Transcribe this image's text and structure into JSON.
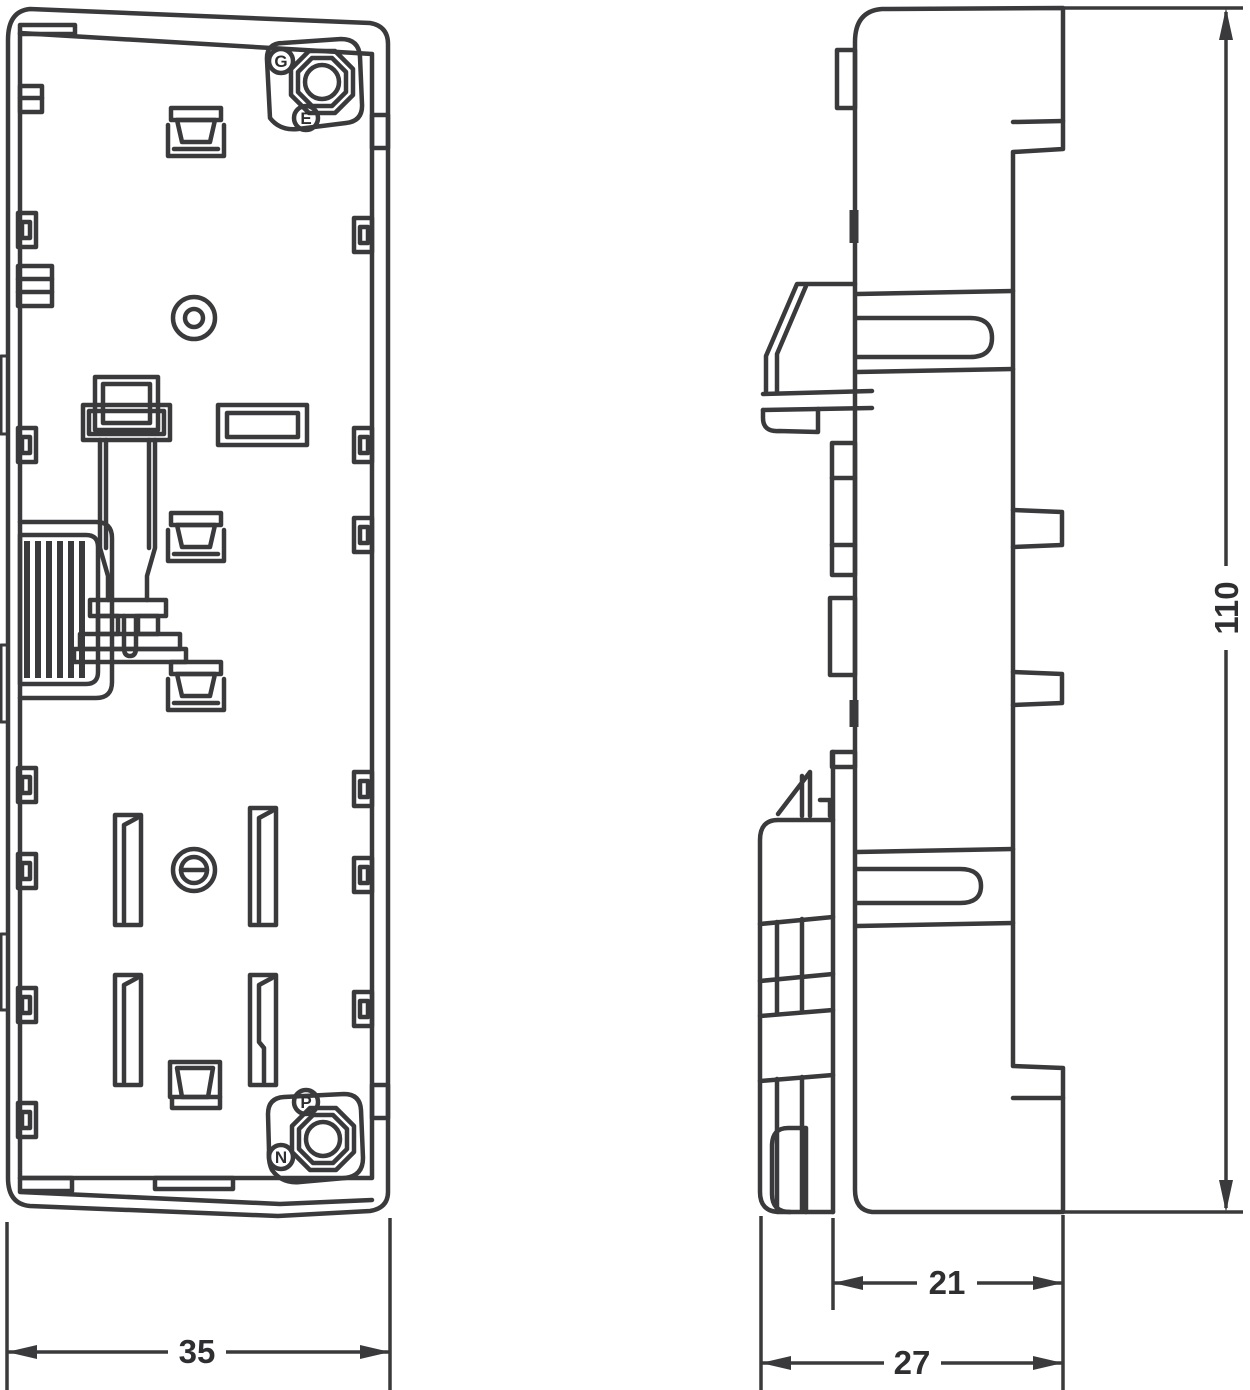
{
  "colors": {
    "line": "#3a3a3c",
    "text": "#2f2f31",
    "background": "#ffffff"
  },
  "front_view": {
    "terminals": {
      "g": "G",
      "e": "E",
      "p": "P",
      "n": "N"
    },
    "width": "35"
  },
  "side_view": {
    "height": "110",
    "body_depth": "21",
    "overall_depth": "27"
  }
}
